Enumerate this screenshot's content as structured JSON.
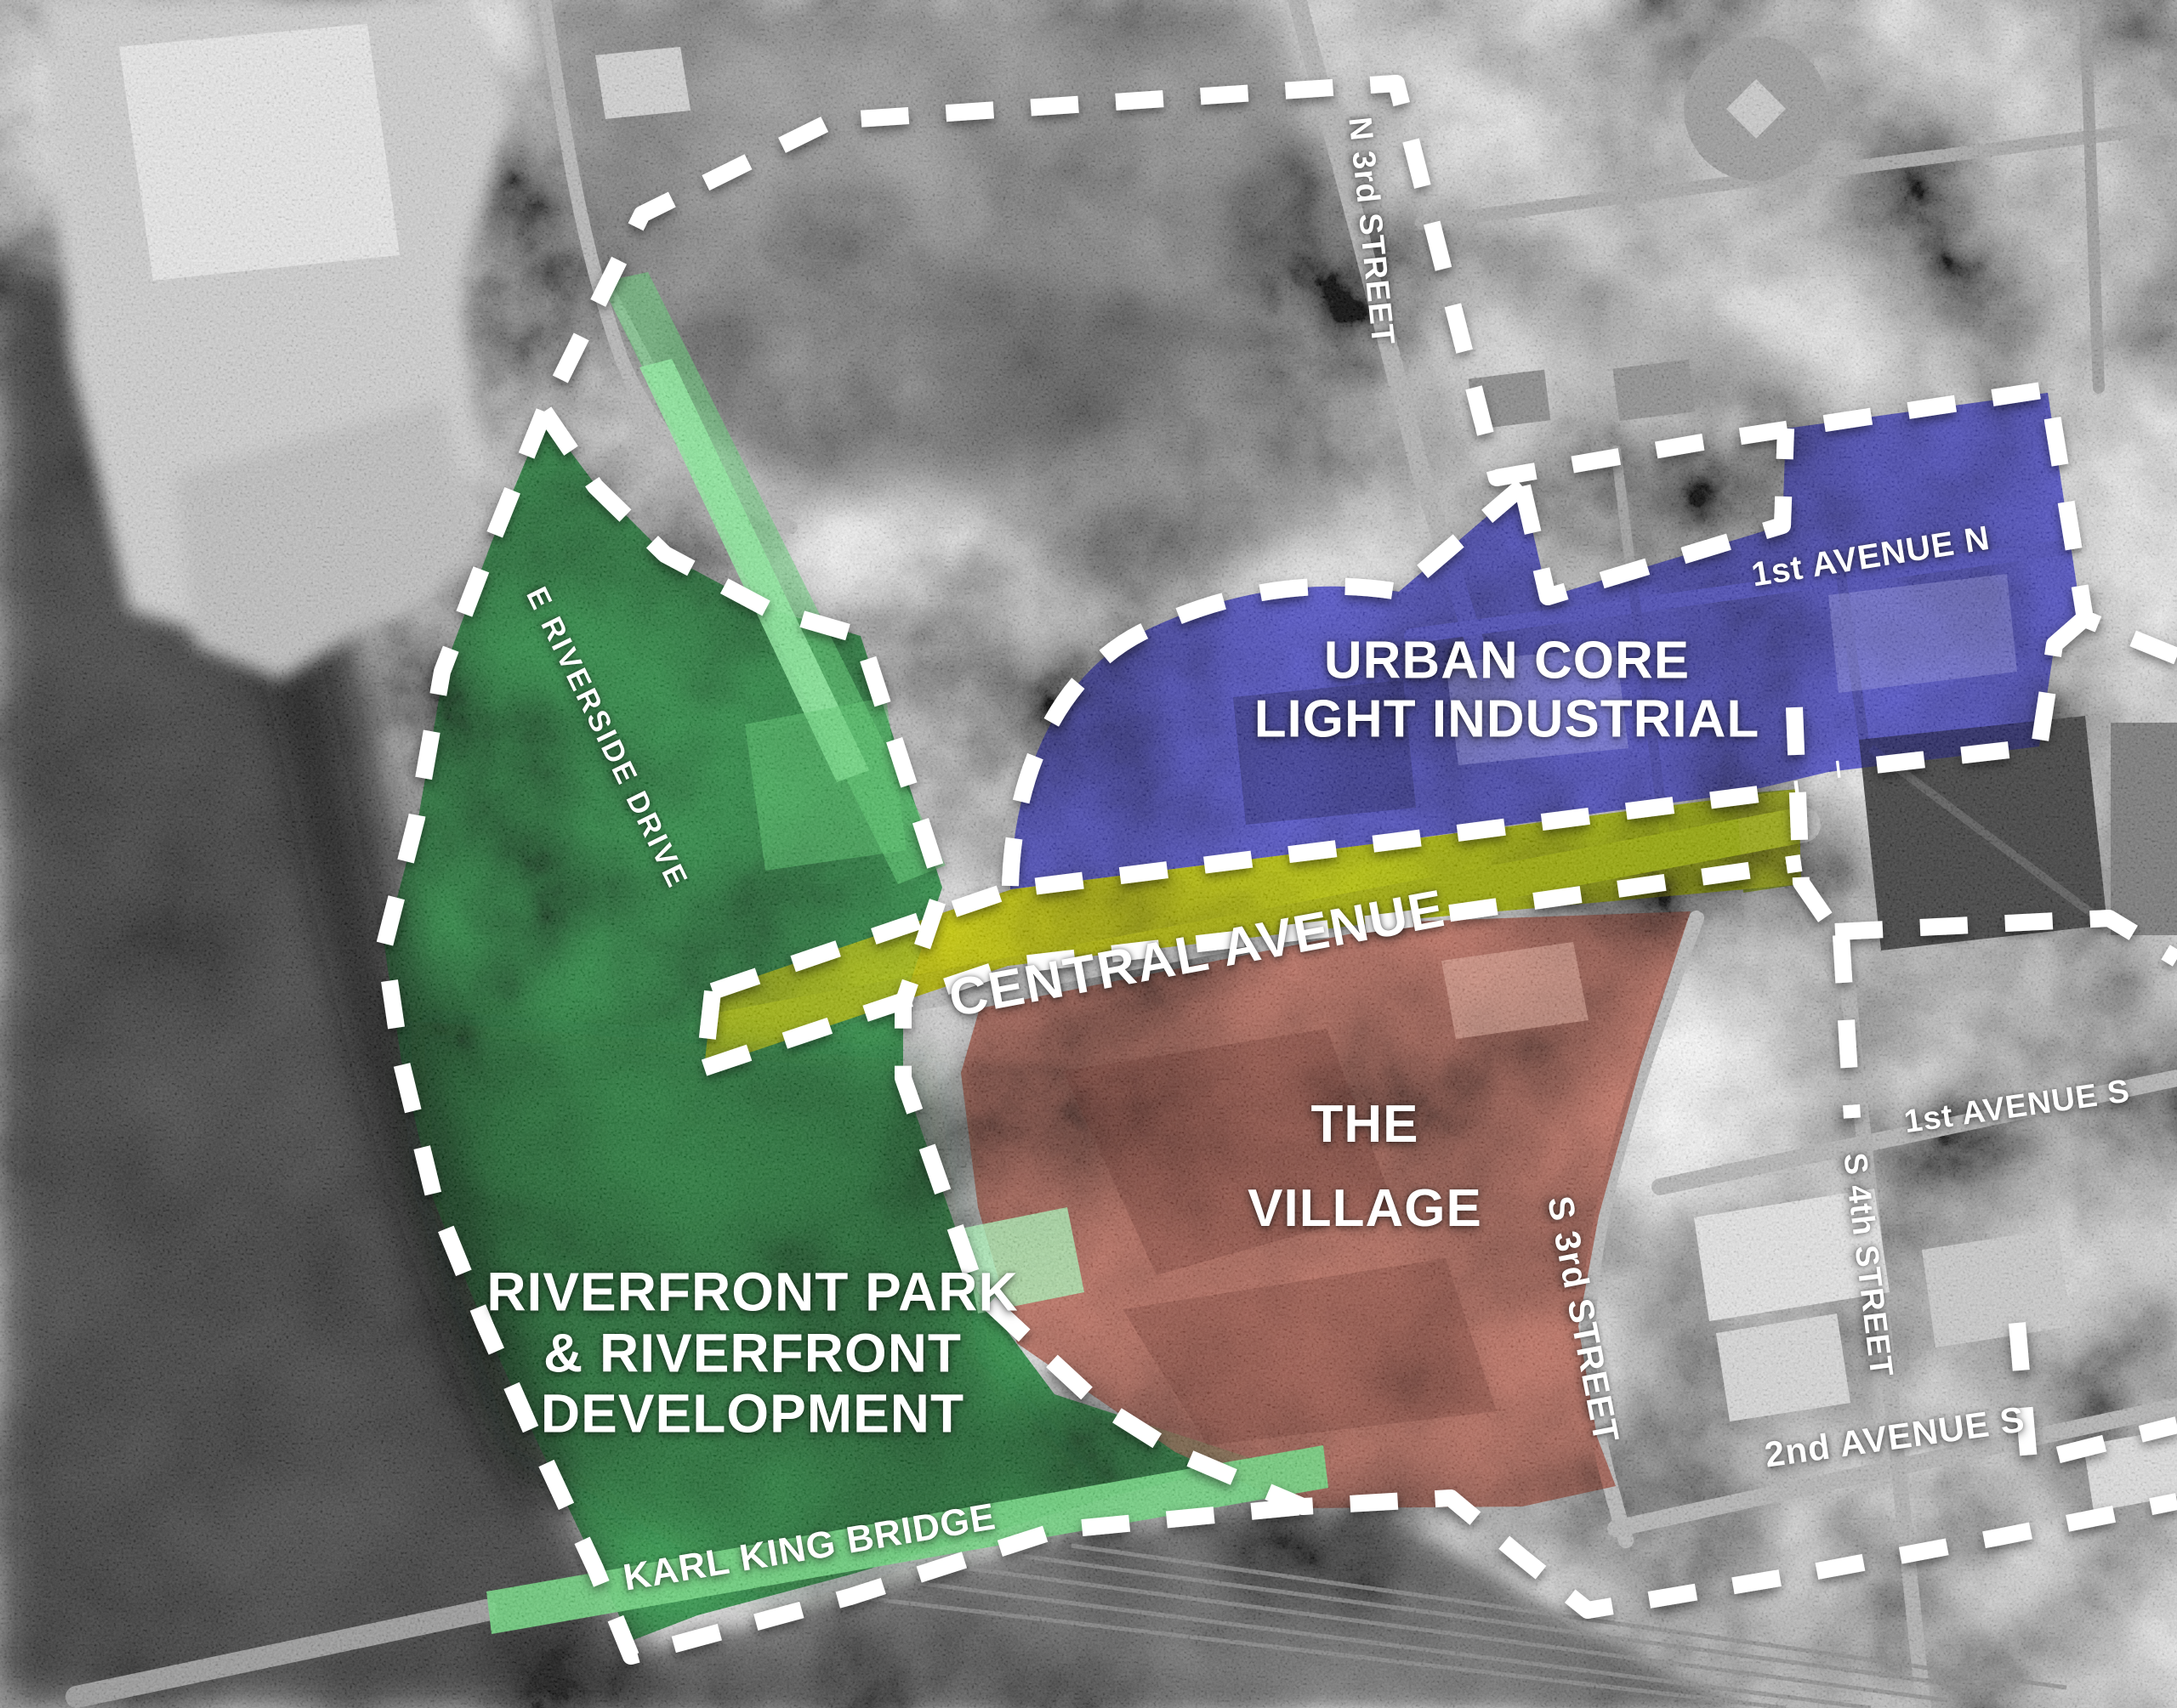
{
  "map": {
    "type": "urban-planning-district-aerial-map",
    "zones": {
      "urban_core": {
        "line1": "URBAN CORE",
        "line2": "LIGHT INDUSTRIAL",
        "color": "#4646c8"
      },
      "village": {
        "line1": "THE",
        "line2": "VILLAGE",
        "color": "#c4705c"
      },
      "riverfront": {
        "line1": "RIVERFRONT PARK",
        "line2": "& RIVERFRONT",
        "line3": "DEVELOPMENT",
        "color": "#2e9e4a"
      },
      "central_avenue": {
        "label": "CENTRAL AVENUE",
        "color": "#c6d80a"
      },
      "karl_king_bridge": {
        "label": "KARL KING BRIDGE",
        "color": "#6fd57f"
      }
    },
    "streets": {
      "n_3rd": "N 3rd STREET",
      "ave_1n": "1st AVENUE N",
      "riverside": "E RIVERSIDE DRIVE",
      "ave_1s": "1st AVENUE S",
      "s_4th": "S 4th STREET",
      "s_3rd": "S 3rd STREET",
      "ave_2s": "2nd AVENUE S"
    },
    "boundary_color": "#ffffff"
  }
}
